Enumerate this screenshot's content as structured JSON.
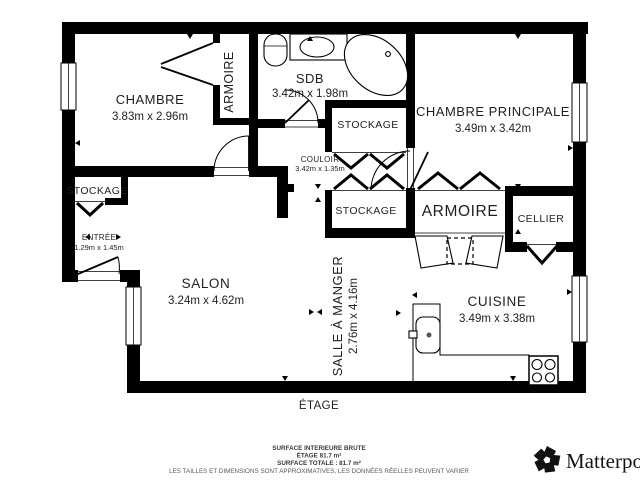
{
  "rooms": {
    "chambre": {
      "name": "CHAMBRE",
      "dims": "3.83m x 2.96m"
    },
    "sdb": {
      "name": "SDB",
      "dims": "3.42m x 1.98m"
    },
    "chambre_principale": {
      "name": "CHAMBRE PRINCIPALE",
      "dims": "3.49m x 3.42m"
    },
    "couloir": {
      "name": "COULOIR",
      "dims": "3.42m x 1.35m"
    },
    "entree": {
      "name": "ENTRÉE",
      "dims": "1.29m x 1.45m"
    },
    "salon": {
      "name": "SALON",
      "dims": "3.24m x 4.62m"
    },
    "salle_a_manger": {
      "name": "SALLE À MANGER",
      "dims": "2.76m x 4.16m"
    },
    "cuisine": {
      "name": "CUISINE",
      "dims": "3.49m x 3.38m"
    },
    "armoire_chambre": {
      "name": "ARMOIRE"
    },
    "stockage_sdb": {
      "name": "STOCKAGE"
    },
    "stockage_couloir": {
      "name": "STOCKAGE"
    },
    "stockage_entree": {
      "name": "STOCKAGE"
    },
    "armoire_couloir": {
      "name": "ARMOIRE"
    },
    "cellier": {
      "name": "CELLIER"
    }
  },
  "floor": {
    "label": "ÉTAGE"
  },
  "footer": {
    "line1": "SURFACE INTERIEURE BRUTE",
    "line2": "ÉTAGE 81.7 m²",
    "line3": "SURFACE TOTALE :  81.7 m²",
    "line4": "LES TAILLES ET DIMENSIONS SONT APPROXIMATIVES, LES DONNÉES RÉELLES PEUVENT VARIER"
  },
  "branding": {
    "wordmark": "Matterport"
  },
  "colors": {
    "walls": "#000000",
    "room_text": "#1f1f1f",
    "footer_text": "#3a3a3a",
    "background": "#ffffff"
  }
}
